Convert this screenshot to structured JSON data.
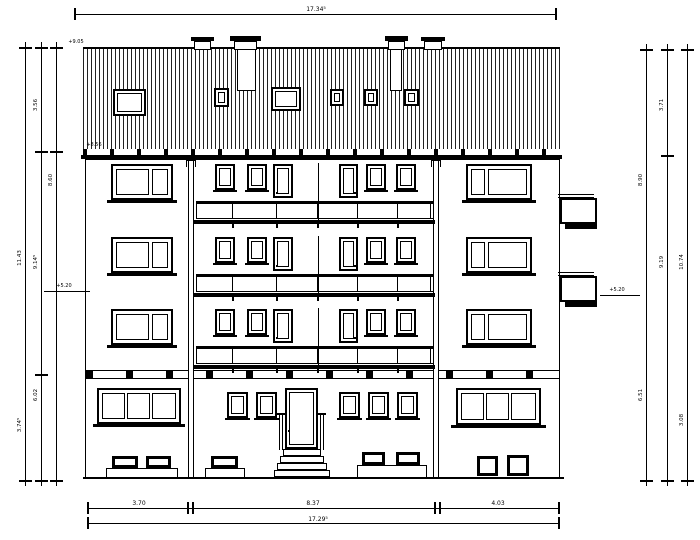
{
  "dimensions": {
    "top_total": "17.34⁵",
    "bottom_total": "17.29⁵",
    "bottom_segments": [
      "3.70",
      "8.37",
      "4.03"
    ],
    "left": {
      "total": "11.43",
      "roof": "3.56",
      "wall": "9.14⁵",
      "eaves": "8.60",
      "ground": "6.02",
      "base": "3.74⁵"
    },
    "right": {
      "roof": "3.71",
      "wall": "8.90",
      "upper": "9.19",
      "total": "10.74",
      "ground": "6.51",
      "base": "3.08"
    }
  },
  "levels": {
    "ridge": "+9.05",
    "eaves": "+8.56",
    "floor_left": "+5.20",
    "floor_right": "+5.20"
  }
}
